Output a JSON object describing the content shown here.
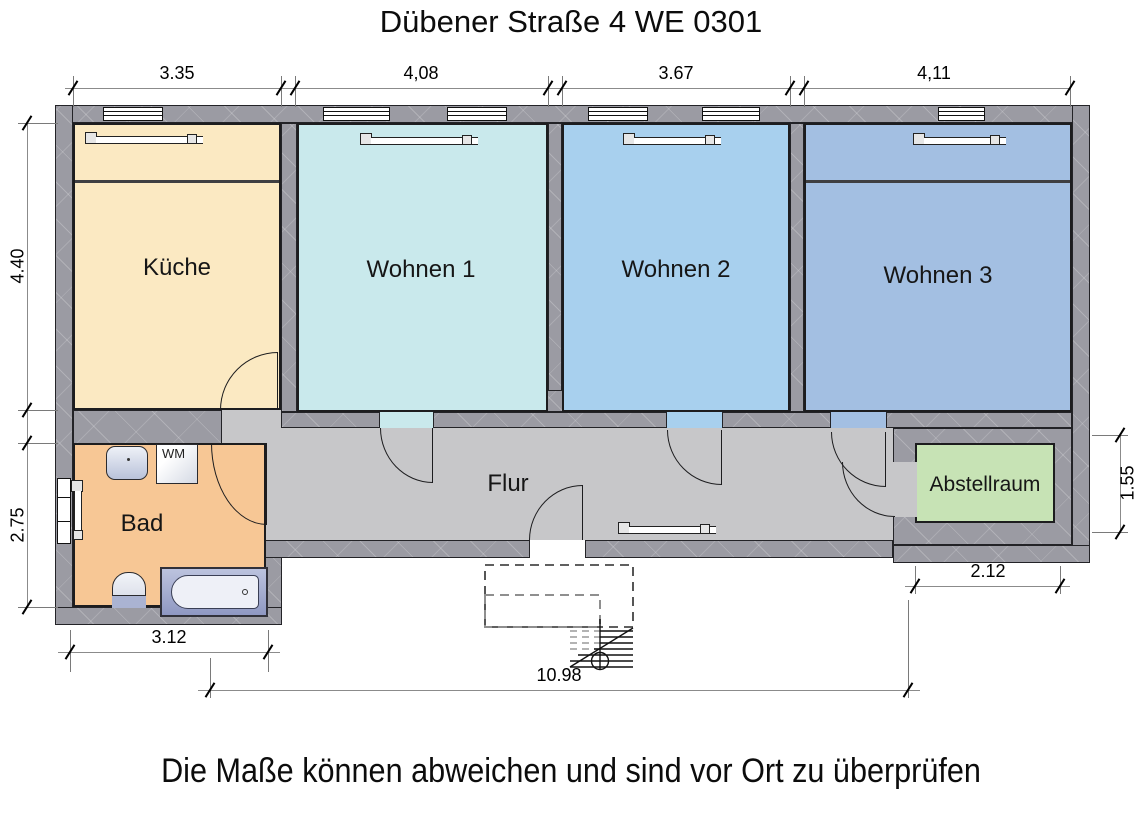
{
  "title": "Dübener Straße 4 WE 0301",
  "footnote": "Die Maße können abweichen und sind vor Ort zu überprüfen",
  "rooms": {
    "kueche": {
      "label": "Küche",
      "color": "#FBE9C2"
    },
    "wohnen1": {
      "label": "Wohnen 1",
      "color": "#C9E9EC"
    },
    "wohnen2": {
      "label": "Wohnen 2",
      "color": "#A8D0EE"
    },
    "wohnen3": {
      "label": "Wohnen 3",
      "color": "#A3BFE2"
    },
    "flur": {
      "label": "Flur",
      "color": "#C7C7C9"
    },
    "bad": {
      "label": "Bad",
      "color": "#F7C795"
    },
    "abstellraum": {
      "label": "Abstellraum",
      "color": "#C7E3B5"
    },
    "wm": {
      "label": "WM"
    }
  },
  "dimensions": {
    "top": [
      "3.35",
      "4,08",
      "3.67",
      "4,11"
    ],
    "left": [
      "4.40",
      "2.75"
    ],
    "right": [
      "1.55"
    ],
    "bottom_bad": "3.12",
    "bottom_abstell": "2.12",
    "bottom_total": "10.98"
  },
  "wall_color": "#9B9BA3"
}
